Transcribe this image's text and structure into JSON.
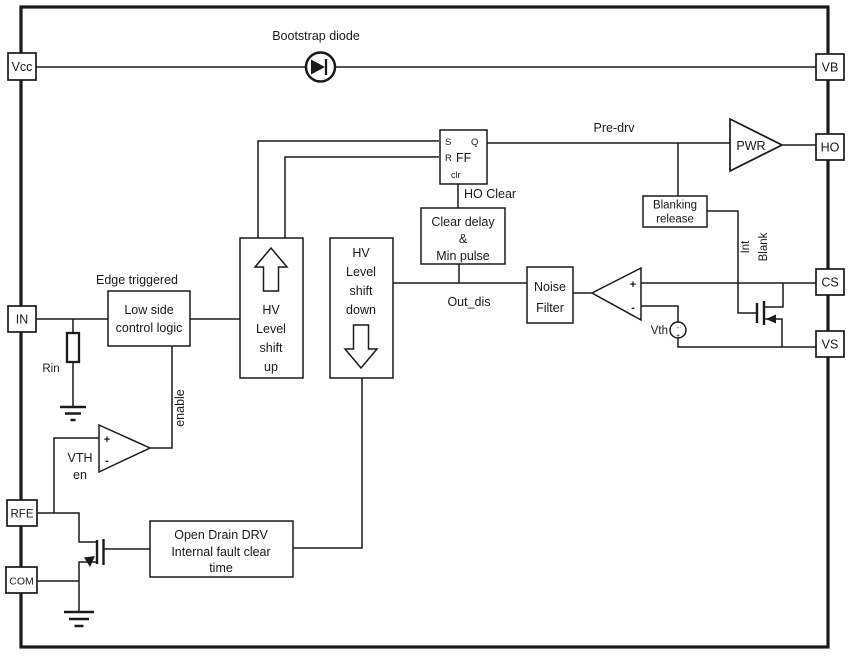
{
  "colors": {
    "ink": "#1a1a1a",
    "background": "#ffffff"
  },
  "pins": {
    "vcc": "Vcc",
    "in": "IN",
    "rfe": "RFE",
    "com": "COM",
    "vb": "VB",
    "ho": "HO",
    "cs": "CS",
    "vs": "VS"
  },
  "labels": {
    "bootstrap_diode": "Bootstrap diode",
    "pre_drv": "Pre-drv",
    "ho_clear": "HO Clear",
    "out_dis": "Out_dis",
    "vth": "Vth",
    "edge_triggered": "Edge triggered",
    "rin": "Rin",
    "enable": "enable",
    "int": "Int",
    "blank": "Blank",
    "plus": "+",
    "minus": "-"
  },
  "blocks": {
    "ff": {
      "s": "S",
      "q": "Q",
      "r": "R",
      "name": "FF",
      "clr": "clr"
    },
    "low_side": {
      "lines": [
        "Low side",
        "control logic"
      ]
    },
    "hv_up": {
      "lines": [
        "HV",
        "Level",
        "shift",
        "up"
      ]
    },
    "hv_down": {
      "lines": [
        "HV",
        "Level",
        "shift",
        "down"
      ]
    },
    "clear_delay": {
      "lines": [
        "Clear delay",
        "&",
        "Min pulse"
      ]
    },
    "noise_filter": {
      "lines": [
        "Noise",
        "Filter"
      ]
    },
    "blanking_release": {
      "lines": [
        "Blanking",
        "release"
      ]
    },
    "pwr": "PWR",
    "open_drain": {
      "lines": [
        "Open Drain DRV",
        "Internal fault clear",
        "time"
      ]
    },
    "vth_en": {
      "lines": [
        "VTH",
        "en"
      ]
    }
  }
}
